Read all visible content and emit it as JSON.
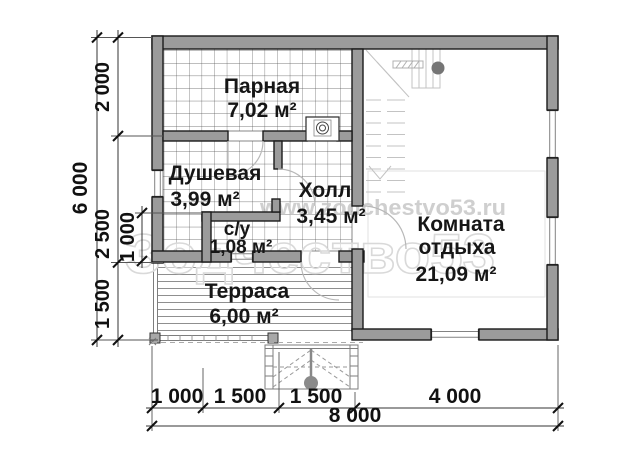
{
  "plan": {
    "watermark_url": "www.zodchestvo53.ru",
    "watermark_brand": "Зодчество53",
    "rooms": {
      "parnaya": {
        "name": "Парная",
        "area": "7,02 м²"
      },
      "dushevaya": {
        "name": "Душевая",
        "area": "3,99 м²"
      },
      "holl": {
        "name": "Холл",
        "area": "3,45 м²"
      },
      "su": {
        "name": "с/у",
        "area": "1,08 м²"
      },
      "komnata": {
        "name_line1": "Комната",
        "name_line2": "отдыха",
        "area": "21,09 м²"
      },
      "terrasa": {
        "name": "Терраса",
        "area": "6,00 м²"
      }
    },
    "dimensions": {
      "left_total": "6 000",
      "left_chain": [
        "2 000",
        "2 500",
        "1 500"
      ],
      "left_inner": "1 000",
      "bottom_chain": [
        "1 000",
        "1 500",
        "1 500",
        "4 000"
      ],
      "bottom_total": "8 000"
    },
    "colors": {
      "wall_fill": "#9b9b9b",
      "wall_stroke": "#1b1b1b",
      "tile_line": "#4f4f4f",
      "watermark": "#d9d9d9",
      "label_text": "#161616"
    }
  }
}
